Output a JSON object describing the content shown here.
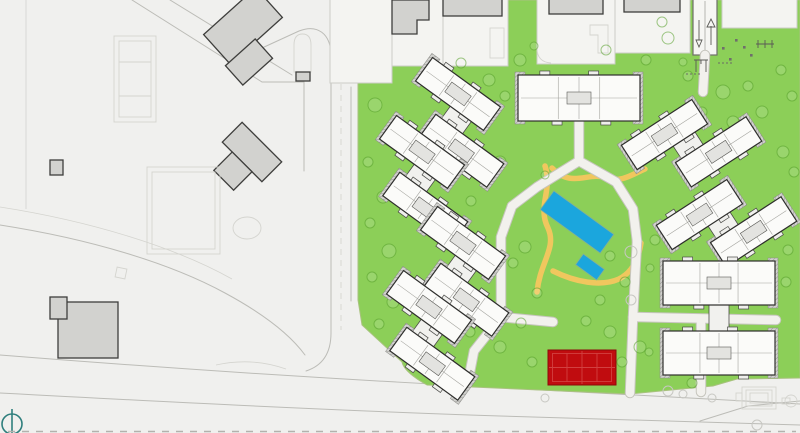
{
  "meta": {
    "drawing_type": "residential-site-master-plan",
    "visible_text": ""
  },
  "theme": {
    "bg": "#f0f0ee",
    "plot": "#f4f4f1",
    "roof": "#d2d2cf",
    "grass": "#8ccf58",
    "road": "#bcbcb7",
    "roadFaint": "#d4d4cf",
    "path": "#f2f1ed",
    "pathCase": "#c6c5bd",
    "sand": "#f0c75e",
    "pool": "#1ba6dd",
    "court": "#c00c0f",
    "teal": "#2f7f7d"
  },
  "site": {
    "residential_buildings_count": 8,
    "facilities": [
      {
        "name": "swimming-pool",
        "color": "#1ba6dd"
      },
      {
        "name": "kids-pool",
        "color": "#1ba6dd"
      },
      {
        "name": "sports-court",
        "color": "#c00c0f"
      },
      {
        "name": "playground",
        "color": "#5a5a56"
      },
      {
        "name": "entry-ramp-with-arrows",
        "color": "#6e6e6a"
      },
      {
        "name": "sand-paths",
        "color": "#f0c75e"
      },
      {
        "name": "north-compass",
        "color": "#2f7f7d"
      }
    ]
  },
  "drawing": {
    "clusters": [
      {
        "id": "block-1",
        "type": "single",
        "x": 579,
        "y": 98,
        "rot": 0
      },
      {
        "id": "block-2",
        "type": "duo",
        "x": 457,
        "y": 126,
        "rot": 36
      },
      {
        "id": "block-3",
        "type": "duo",
        "x": 421,
        "y": 184,
        "rot": 36
      },
      {
        "id": "block-4",
        "type": "duo",
        "x": 462,
        "y": 275,
        "rot": 36
      },
      {
        "id": "block-5",
        "type": "duo",
        "x": 428,
        "y": 339,
        "rot": 36
      },
      {
        "id": "block-6",
        "type": "duo",
        "x": 694,
        "y": 147,
        "rot": -33
      },
      {
        "id": "block-7",
        "type": "duo",
        "x": 729,
        "y": 227,
        "rot": -33
      },
      {
        "id": "block-8",
        "type": "stack",
        "x": 719,
        "y": 318,
        "rot": 0
      }
    ],
    "trees": [
      [
        375,
        105,
        7
      ],
      [
        390,
        140,
        6
      ],
      [
        368,
        162,
        5
      ],
      [
        383,
        197,
        6
      ],
      [
        370,
        223,
        5
      ],
      [
        389,
        251,
        7
      ],
      [
        372,
        277,
        5
      ],
      [
        393,
        302,
        6
      ],
      [
        379,
        324,
        5
      ],
      [
        404,
        347,
        6
      ],
      [
        432,
        70,
        6
      ],
      [
        461,
        63,
        5
      ],
      [
        489,
        80,
        6
      ],
      [
        520,
        60,
        6
      ],
      [
        534,
        46,
        4
      ],
      [
        606,
        50,
        5
      ],
      [
        646,
        60,
        5
      ],
      [
        662,
        22,
        5
      ],
      [
        688,
        76,
        5
      ],
      [
        505,
        96,
        5
      ],
      [
        500,
        162,
        6
      ],
      [
        471,
        201,
        5
      ],
      [
        455,
        232,
        4
      ],
      [
        525,
        247,
        6
      ],
      [
        513,
        263,
        5
      ],
      [
        537,
        293,
        5
      ],
      [
        521,
        323,
        5
      ],
      [
        472,
        312,
        6
      ],
      [
        610,
        256,
        5
      ],
      [
        600,
        300,
        5
      ],
      [
        625,
        282,
        5
      ],
      [
        586,
        321,
        5
      ],
      [
        610,
        332,
        6
      ],
      [
        640,
        347,
        6
      ],
      [
        622,
        362,
        5
      ],
      [
        649,
        352,
        4
      ],
      [
        470,
        332,
        5
      ],
      [
        500,
        347,
        6
      ],
      [
        532,
        362,
        5
      ],
      [
        692,
        383,
        5
      ],
      [
        655,
        240,
        5
      ],
      [
        650,
        268,
        4
      ],
      [
        723,
        92,
        7
      ],
      [
        748,
        86,
        5
      ],
      [
        762,
        112,
        6
      ],
      [
        781,
        70,
        5
      ],
      [
        792,
        96,
        5
      ],
      [
        733,
        122,
        6
      ],
      [
        702,
        112,
        5
      ],
      [
        668,
        38,
        6
      ],
      [
        683,
        62,
        4
      ],
      [
        783,
        152,
        6
      ],
      [
        794,
        172,
        5
      ],
      [
        788,
        250,
        5
      ],
      [
        786,
        282,
        5
      ],
      [
        545,
        175,
        4
      ]
    ],
    "grey_trees": [
      [
        631,
        252,
        6
      ],
      [
        631,
        300,
        5
      ],
      [
        668,
        391,
        5
      ],
      [
        683,
        394,
        4
      ],
      [
        545,
        398,
        4
      ],
      [
        712,
        398,
        4
      ],
      [
        757,
        425,
        5
      ]
    ],
    "white_paths": [
      "M579,121 L579,161",
      "M579,161 L616,182 L633,209 L637,241",
      "M579,161 L537,187 L512,206",
      "M512,206 L501,237 L501,317",
      "M501,317 L553,322",
      "M501,317 L474,351 L468,382",
      "M637,241 L633,317 L630,393",
      "M633,317 L776,320",
      "M701,320 L701,392",
      "M705,55 L703,92"
    ],
    "yellow_paths": [
      "M545,166 C553,190 537,206 548,228 C557,248 540,262 537,292",
      "M552,168 C572,189 588,171 607,178 C621,183 633,174 645,169",
      "M553,271 C575,282 601,287 619,279 C633,272 639,257 641,243"
    ],
    "roads_main": [
      "M132,0 L262,82",
      "M170,0 L292,75",
      "M262,82 L304,82",
      "M304,82 L304,171",
      "M331,56 C331,33 317,24 299,31 L262,48",
      "M331,56 L331,333",
      "M351,87 L351,301",
      "M331,333 Q331,363 306,371",
      "M0,225 C90,239 170,263 225,293 C262,313 289,333 305,355",
      "M0,355 C150,367 300,377 450,385 C600,393 720,399 800,404",
      "M0,393 C150,401 320,410 500,416 C640,420 730,422 800,425",
      "M700,421 L748,406 L800,401"
    ],
    "roads_faint": [
      "M26,0 L26,209",
      "M0,207 C90,221 175,247 232,279",
      "M216,365 Q252,357 286,369",
      "M713,386 L737,379 L800,378"
    ],
    "roads_dash": [
      "M341,62 L341,330"
    ]
  }
}
